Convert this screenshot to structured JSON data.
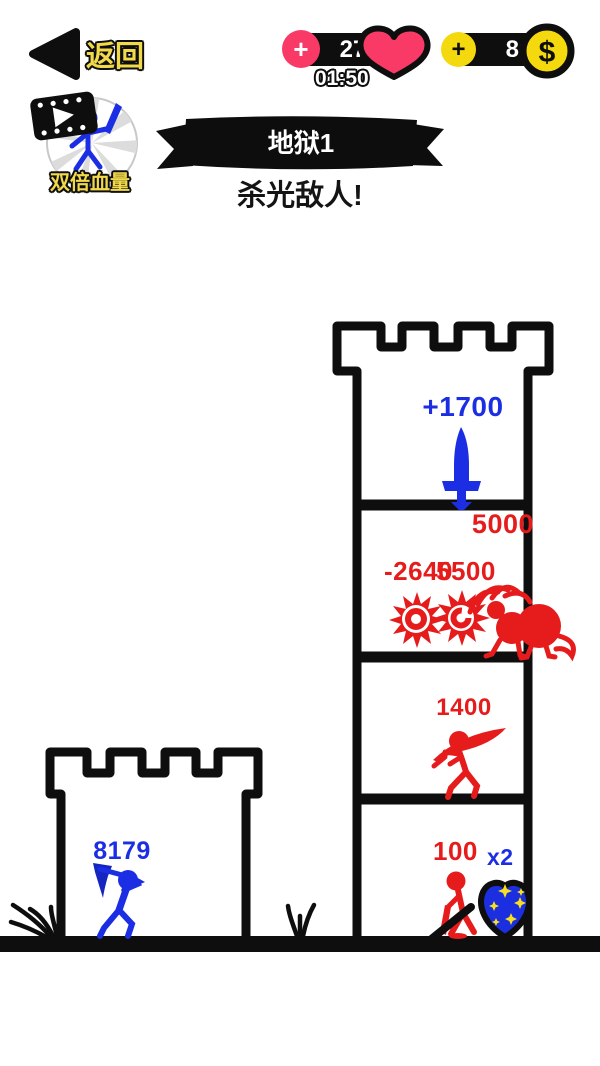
{
  "colors": {
    "blue": "#1c2ee4",
    "red": "#e61c1c",
    "pink": "#fa3a66",
    "coin_yellow": "#f5d90f",
    "label_yellow": "#f2d94a",
    "ink": "#0e0e0e"
  },
  "top_bar": {
    "back_label": "返回",
    "health": {
      "plus_label": "+",
      "value": "27",
      "timer": "01:50",
      "icon": "heart-icon"
    },
    "coins": {
      "plus_label": "+",
      "value": "80",
      "symbol": "$",
      "icon": "coin-icon"
    }
  },
  "ad_booster": {
    "label": "双倍血量",
    "icon": "video-ad-stickman-icon"
  },
  "level": {
    "banner_title": "地狱1",
    "objective": "杀光敌人!"
  },
  "enemy_tower": {
    "floor_top": {
      "attack_bonus": "+1700",
      "icon": "sword-icon"
    },
    "floor_monsters": {
      "hp_total": "5000",
      "floating_damage": "-2640",
      "monster_hp": "5500"
    },
    "floor_warrior": {
      "hp": "1400"
    },
    "floor_ground": {
      "hp": "100",
      "multiplier": "x2",
      "icon": "shield-icon"
    }
  },
  "player_castle": {
    "hp": "8179"
  }
}
